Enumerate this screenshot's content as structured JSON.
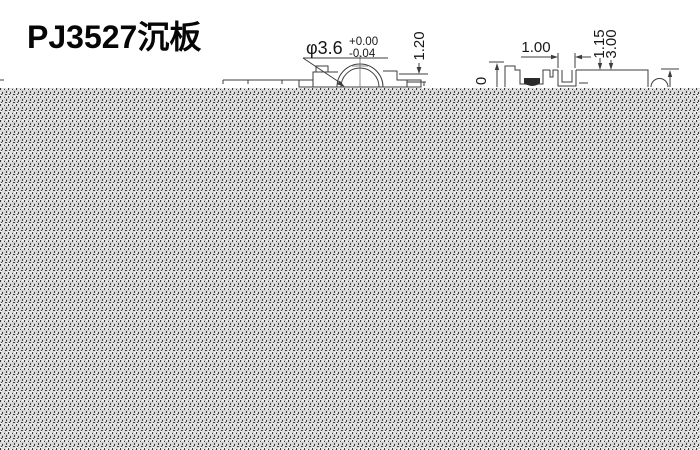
{
  "title": "PJ3527沉板",
  "front_view": {
    "diameter_label": "φ3.6",
    "tolerance_upper": "+0.00",
    "tolerance_lower": "-0.04",
    "height_label": "1.20"
  },
  "side_view": {
    "pitch_label": "1.00",
    "zero_label": "0",
    "depth_label_a": "1.15",
    "depth_label_b": "3.00"
  },
  "colors": {
    "background": "#ffffff",
    "line": "#3d3d3d",
    "text": "#161616",
    "halftone_bg": "#d7d7d7",
    "halftone_dark": "#3a3a3a",
    "halftone_light": "#f6f6f6"
  }
}
